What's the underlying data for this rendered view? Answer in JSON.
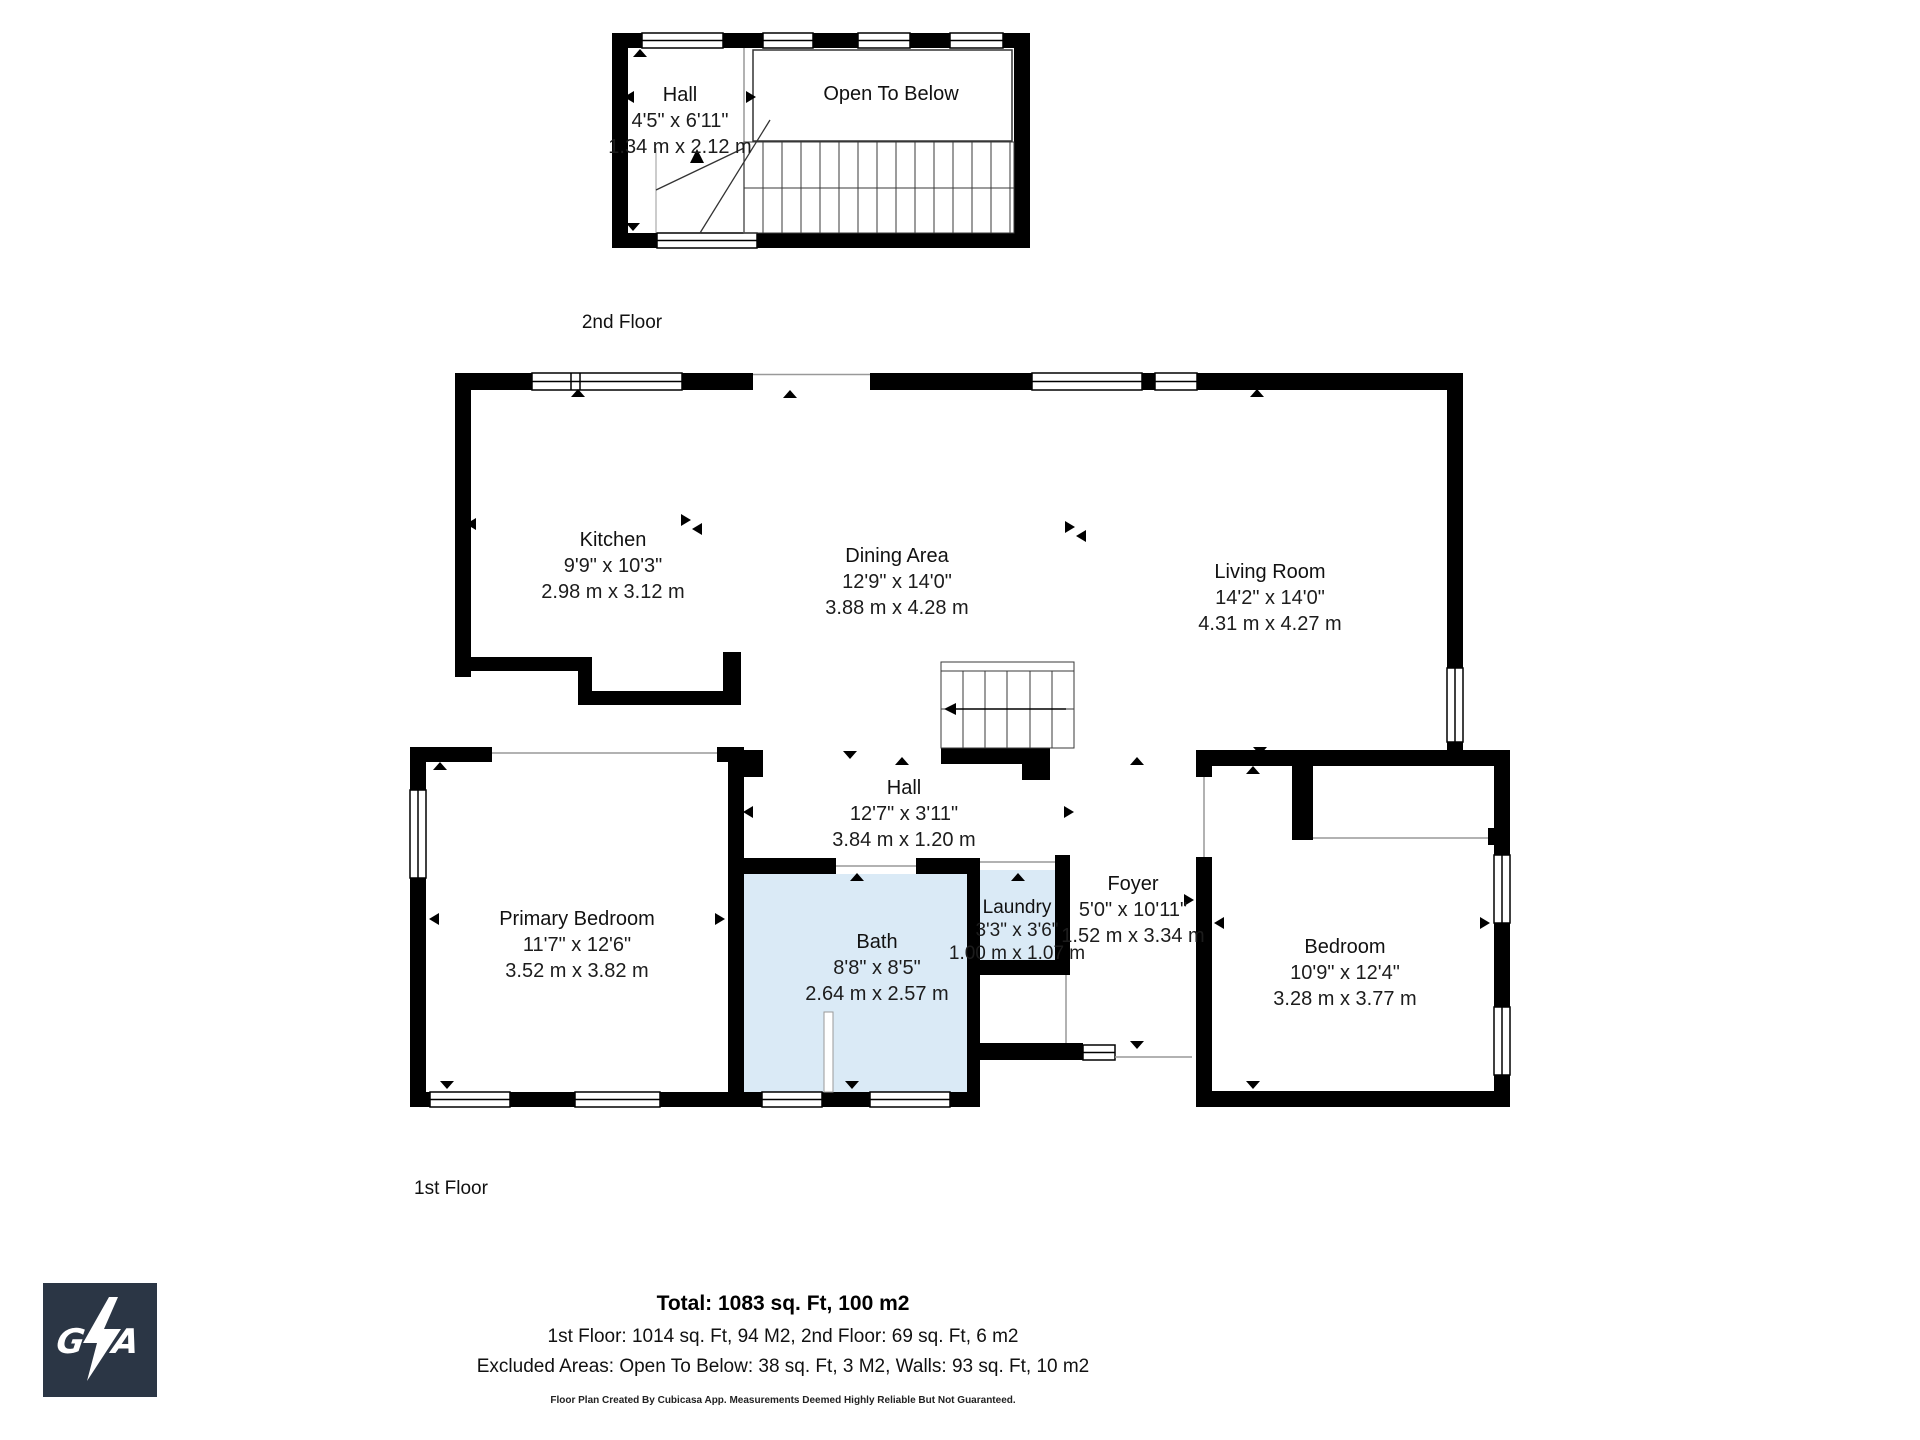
{
  "second_floor": {
    "label": "2nd Floor",
    "hall": {
      "name": "Hall",
      "imperial": "4'5\" x 6'11\"",
      "metric": "1.34 m x 2.12 m"
    },
    "open_to_below": {
      "name": "Open To Below"
    }
  },
  "first_floor": {
    "label": "1st Floor",
    "kitchen": {
      "name": "Kitchen",
      "imperial": "9'9\" x 10'3\"",
      "metric": "2.98 m x 3.12 m"
    },
    "dining": {
      "name": "Dining Area",
      "imperial": "12'9\" x 14'0\"",
      "metric": "3.88 m x 4.28 m"
    },
    "living": {
      "name": "Living Room",
      "imperial": "14'2\" x 14'0\"",
      "metric": "4.31 m x 4.27 m"
    },
    "hall": {
      "name": "Hall",
      "imperial": "12'7\" x 3'11\"",
      "metric": "3.84 m x 1.20 m"
    },
    "primary_bedroom": {
      "name": "Primary Bedroom",
      "imperial": "11'7\" x 12'6\"",
      "metric": "3.52 m x 3.82 m"
    },
    "bath": {
      "name": "Bath",
      "imperial": "8'8\" x 8'5\"",
      "metric": "2.64 m x 2.57 m"
    },
    "laundry": {
      "name": "Laundry",
      "imperial": "3'3\" x 3'6\"",
      "metric": "1.00 m x 1.07 m"
    },
    "foyer": {
      "name": "Foyer",
      "imperial": "5'0\" x 10'11\"",
      "metric": "1.52 m x 3.34 m"
    },
    "bedroom": {
      "name": "Bedroom",
      "imperial": "10'9\" x 12'4\"",
      "metric": "3.28 m x 3.77 m"
    }
  },
  "summary": {
    "total": "Total: 1083 sq. Ft, 100 m2",
    "floors": "1st Floor: 1014 sq. Ft, 94 M2, 2nd Floor: 69 sq. Ft, 6 m2",
    "excluded": "Excluded Areas: Open To Below: 38 sq. Ft, 3 M2, Walls: 93 sq. Ft, 10 m2",
    "disclaimer": "Floor Plan Created By Cubicasa App. Measurements Deemed Highly Reliable But Not Guaranteed."
  },
  "logo": {
    "text": "GZA"
  },
  "colors": {
    "wall": "#000000",
    "wet_room_fill": "#daeaf6",
    "thin_line": "#999999",
    "logo_bg": "#2b3645"
  }
}
